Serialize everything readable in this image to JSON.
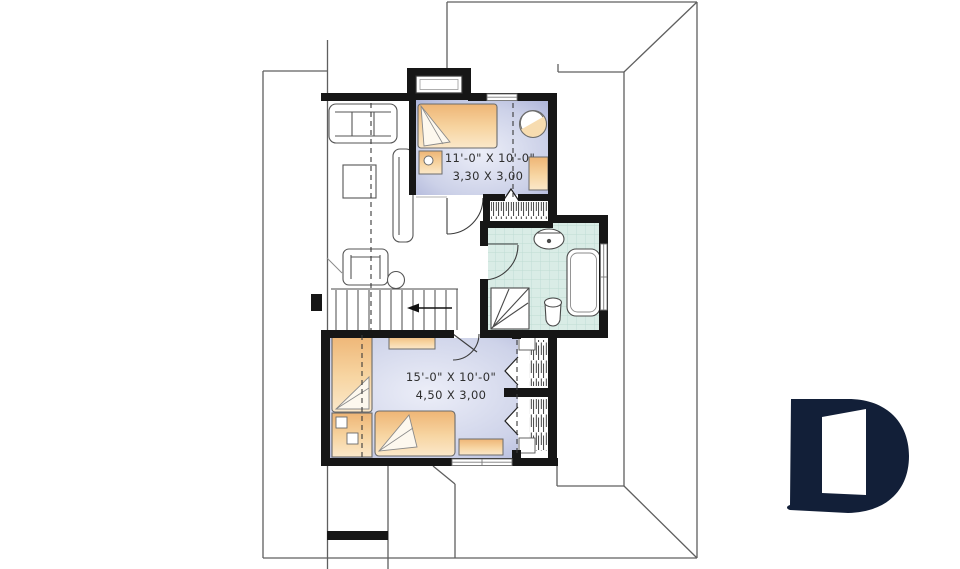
{
  "rooms": {
    "upper_bedroom": {
      "imperial": "11'-0\" X 10'-0\"",
      "metric": "3,30 X 3,00"
    },
    "lower_bedroom": {
      "imperial": "15'-0\" X 10'-0\"",
      "metric": "4,50 X 3,00"
    }
  },
  "colors": {
    "wall_black": "#161616",
    "furniture_tan": "#f2bf7f",
    "furniture_tan_light": "#fbe8ca",
    "bedroom_floor_edge": "#a6add5",
    "bedroom_floor_center": "#eceef8",
    "bathroom_tile": "#d9ece6",
    "bathroom_tile_line": "#bedbd3",
    "roof_line_gray": "#5f5f5f",
    "logo_navy": "#121f38"
  },
  "logo": {
    "icon": "drummond-d-logo"
  }
}
